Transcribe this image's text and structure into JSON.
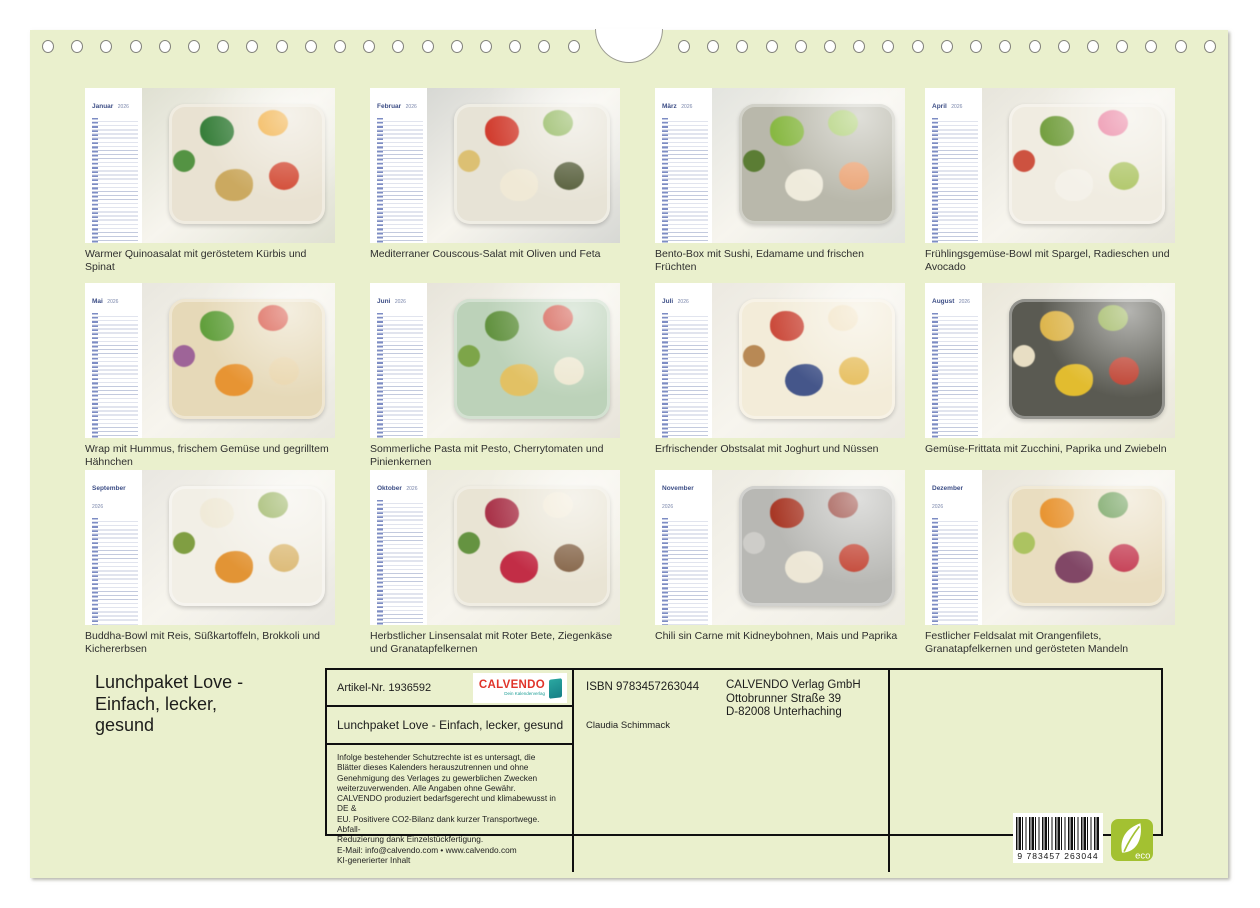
{
  "page": {
    "bg_color": "#eaf0cd",
    "title_lines": [
      "Lunchpaket Love -",
      "Einfach, lecker,",
      "gesund"
    ]
  },
  "calendar_year": "2026",
  "months": [
    {
      "name": "Januar",
      "caption": "Warmer Quinoasalat mit geröstetem Kürbis und Spinat",
      "photo": {
        "bg": "#dfe0d2",
        "box": "#e9e2d2",
        "accents": [
          "#2f7a33",
          "#f0a01f",
          "#caa75a",
          "#cf3a23",
          "#4d8f3c"
        ]
      }
    },
    {
      "name": "Februar",
      "caption": "Mediterraner Couscous-Salat mit Oliven und Feta",
      "photo": {
        "bg": "#d7d8d4",
        "box": "#e7e3d6",
        "accents": [
          "#d03527",
          "#7aa93c",
          "#f1ead6",
          "#47502a",
          "#dcbf6e"
        ]
      }
    },
    {
      "name": "März",
      "caption": "Bento-Box mit Sushi, Edamame und frischen Früchten",
      "photo": {
        "bg": "#e3e4df",
        "box": "#b9b8ab",
        "accents": [
          "#86b83e",
          "#a1c95e",
          "#f2eedf",
          "#eda06e",
          "#567a2e"
        ]
      }
    },
    {
      "name": "April",
      "caption": "Frühlingsgemüse-Bowl mit Spargel, Radieschen und Avocado",
      "photo": {
        "bg": "#e7e5dc",
        "box": "#f0ece1",
        "accents": [
          "#6f9c3a",
          "#e76f93",
          "#f5f2ea",
          "#a9c25c",
          "#cc4a38"
        ]
      }
    },
    {
      "name": "Mai",
      "caption": "Wrap mit Hummus, frischem Gemüse und gegrilltem Hähnchen",
      "photo": {
        "bg": "#e9e7df",
        "box": "#e6d9b8",
        "accents": [
          "#5a9c36",
          "#d23b2a",
          "#e8912c",
          "#ead6ad",
          "#9b5e97"
        ]
      }
    },
    {
      "name": "Juni",
      "caption": "Sommerliche Pasta mit Pesto, Cherrytomaten und Pinienkernen",
      "photo": {
        "bg": "#e7e4da",
        "box": "#bcd2b9",
        "accents": [
          "#5e8f3a",
          "#cd3a2b",
          "#e5c160",
          "#f0e9d2",
          "#7aa344"
        ]
      }
    },
    {
      "name": "Juli",
      "caption": "Erfrischender Obstsalat mit Joghurt und Nüssen",
      "photo": {
        "bg": "#ece9e1",
        "box": "#f3ecd9",
        "accents": [
          "#c94334",
          "#f0e0bd",
          "#3c4f86",
          "#e5b94f",
          "#b5844e"
        ]
      }
    },
    {
      "name": "August",
      "caption": "Gemüse-Frittata mit Zucchini, Paprika und Zwiebeln",
      "photo": {
        "bg": "#eae7da",
        "box": "#5a5a52",
        "accents": [
          "#e5bb4e",
          "#8fae42",
          "#eac22e",
          "#c23a28",
          "#f0e6cb"
        ]
      }
    },
    {
      "name": "September",
      "caption": "Buddha-Bowl mit Reis, Süßkartoffeln, Brokkoli und Kichererbsen",
      "photo": {
        "bg": "#e9e7e1",
        "box": "#f2efe6",
        "accents": [
          "#f0ead8",
          "#86a542",
          "#e2902c",
          "#d9b468",
          "#7a9a3a"
        ]
      }
    },
    {
      "name": "Oktober",
      "caption": "Herbstlicher Linsensalat mit Roter Bete, Ziegenkäse und Granatapfelkernen",
      "photo": {
        "bg": "#eceade",
        "box": "#e9e4d4",
        "accents": [
          "#a62a42",
          "#f2ead6",
          "#c0243f",
          "#7a5638",
          "#5e8f3a"
        ]
      }
    },
    {
      "name": "November",
      "caption": "Chili sin Carne mit Kidneybohnen, Mais und Paprika",
      "photo": {
        "bg": "#edebe2",
        "box": "#b8b8b4",
        "accents": [
          "#a8321f",
          "#8a2a20",
          "#f0ead8",
          "#c23a28",
          "#d0cfcb"
        ]
      }
    },
    {
      "name": "Dezember",
      "caption": "Festlicher Feldsalat mit Orangenfilets, Granatapfelkernen und gerösteten Mandeln",
      "photo": {
        "bg": "#e8e5db",
        "box": "#e9ddc0",
        "accents": [
          "#e8922c",
          "#4e8a35",
          "#7c3f62",
          "#c02c45",
          "#a9c25c"
        ]
      }
    }
  ],
  "info_table": {
    "artikel_label": "Artikel-Nr. 1936592",
    "product_title": "Lunchpaket Love - Einfach, lecker, gesund",
    "legal_lines": [
      "Infolge bestehender Schutzrechte ist es untersagt, die",
      "Blätter dieses Kalenders herauszutrennen und ohne",
      "Genehmigung des Verlages zu gewerblichen Zwecken",
      "weiterzuverwenden. Alle Angaben ohne Gewähr.",
      "CALVENDO produziert bedarfsgerecht und klimabewusst in DE &",
      "EU. Positivere CO2-Bilanz dank kurzer Transportwege. Abfall-",
      "Reduzierung dank Einzelstückfertigung.",
      "E-Mail: info@calvendo.com • www.calvendo.com",
      "KI-generierter Inhalt"
    ],
    "isbn": "ISBN 9783457263044",
    "author": "Claudia Schimmack",
    "publisher_lines": [
      "CALVENDO Verlag GmbH",
      "Ottobrunner Straße 39",
      "D-82008 Unterhaching"
    ],
    "logo": {
      "text": "CALVENDO",
      "tagline": "Dein Kalenderverlag",
      "color": "#e0342a",
      "accent": "#1e9e96"
    },
    "barcode_digits": "9 783457 263044",
    "eco_label": "eco",
    "eco_color": "#a3c131"
  }
}
